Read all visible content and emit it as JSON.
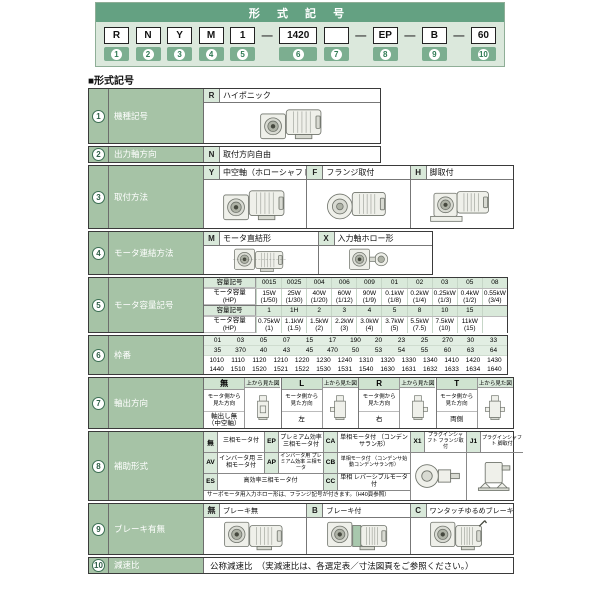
{
  "header": {
    "title": "形 式 記 号",
    "units": [
      {
        "type": "box",
        "text": "R",
        "badge": "1"
      },
      {
        "type": "box",
        "text": "N",
        "badge": "2"
      },
      {
        "type": "box",
        "text": "Y",
        "badge": "3"
      },
      {
        "type": "box",
        "text": "M",
        "badge": "4"
      },
      {
        "type": "box",
        "text": "1",
        "badge": "5"
      },
      {
        "type": "dash",
        "text": "—"
      },
      {
        "type": "box",
        "text": "1420",
        "badge": "6"
      },
      {
        "type": "box",
        "text": "",
        "badge": "7"
      },
      {
        "type": "dash",
        "text": "—"
      },
      {
        "type": "box",
        "text": "EP",
        "badge": "8"
      },
      {
        "type": "dash",
        "text": "—"
      },
      {
        "type": "box",
        "text": "B",
        "badge": "9"
      },
      {
        "type": "dash",
        "text": "—"
      },
      {
        "type": "box",
        "text": "60",
        "badge": "10"
      }
    ]
  },
  "section_heading": "■形式記号",
  "rows": {
    "r1": {
      "num": "1",
      "label": "機種記号",
      "code": "R",
      "desc": "ハイポニック"
    },
    "r2": {
      "num": "2",
      "label": "出力軸方向",
      "code": "N",
      "desc": "取付方向自由"
    },
    "r3": {
      "num": "3",
      "label": "取付方法",
      "items": [
        {
          "code": "Y",
          "desc": "中空軸（ホローシャフト）"
        },
        {
          "code": "F",
          "desc": "フランジ取付"
        },
        {
          "code": "H",
          "desc": "脚取付"
        }
      ]
    },
    "r4": {
      "num": "4",
      "label": "モータ連結方法",
      "items": [
        {
          "code": "M",
          "desc": "モータ直結形"
        },
        {
          "code": "X",
          "desc": "入力軸ホロー形"
        }
      ]
    },
    "r5": {
      "num": "5",
      "label": "モータ容量記号",
      "code_header": "容量記号",
      "cap_header": "モータ容量\n(HP)",
      "t1_codes": [
        "0015",
        "0025",
        "004",
        "006",
        "009",
        "01",
        "02",
        "03",
        "05",
        "08"
      ],
      "t1_caps": [
        "15W\n(1/50)",
        "25W\n(1/30)",
        "40W\n(1/20)",
        "60W\n(1/12)",
        "90W\n(1/9)",
        "0.1kW\n(1/8)",
        "0.2kW\n(1/4)",
        "0.25kW\n(1/3)",
        "0.4kW\n(1/2)",
        "0.55kW\n(3/4)"
      ],
      "t2_codes": [
        "1",
        "1H",
        "2",
        "3",
        "4",
        "5",
        "8",
        "10",
        "15",
        ""
      ],
      "t2_caps": [
        "0.75kW\n(1)",
        "1.1kW\n(1.5)",
        "1.5kW\n(2)",
        "2.2kW\n(3)",
        "3.0kW\n(4)",
        "3.7kW\n(5)",
        "5.5kW\n(7.5)",
        "7.5kW\n(10)",
        "11kW\n(15)",
        ""
      ]
    },
    "r6": {
      "num": "6",
      "label": "枠番",
      "line1": [
        "01",
        "03",
        "05",
        "07",
        "15",
        "17",
        "190",
        "20",
        "23",
        "25",
        "270",
        "30",
        "33"
      ],
      "line2": [
        "35",
        "370",
        "40",
        "43",
        "45",
        "470",
        "50",
        "53",
        "54",
        "55",
        "60",
        "63",
        "64"
      ],
      "line3": [
        "1010",
        "1110",
        "1120",
        "1210",
        "1220",
        "1230",
        "1240",
        "1310",
        "1320",
        "1330",
        "1340",
        "1410",
        "1420",
        "1430"
      ],
      "line4": [
        "1440",
        "1510",
        "1520",
        "1521",
        "1522",
        "1530",
        "1531",
        "1540",
        "1630",
        "1631",
        "1632",
        "1633",
        "1634",
        "1640"
      ]
    },
    "r7": {
      "num": "7",
      "label": "軸出方向",
      "top_view_label": "上から見た図",
      "view_dir_label": "モータ側から\n見た方向",
      "groups": [
        {
          "code": "無",
          "value": "軸出し無\n（中空軸）"
        },
        {
          "code": "L",
          "value": "左"
        },
        {
          "code": "R",
          "value": "右"
        },
        {
          "code": "T",
          "value": "両側"
        }
      ]
    },
    "r8": {
      "num": "8",
      "label": "補助形式",
      "row1": [
        {
          "code": "無",
          "desc": "三相モータ付"
        },
        {
          "code": "EP",
          "desc": "プレミアム効率 三相モータ付"
        },
        {
          "code": "CA",
          "desc": "単相モータ付 （コンデンサラン形）"
        },
        {
          "code": "X1",
          "desc": "プラグインシャフト フランジ取付"
        },
        {
          "code": "J1",
          "desc": "プラグインシャフト 脚取付"
        }
      ],
      "row2": [
        {
          "code": "AV",
          "desc": "インバータ用 三相モータ付"
        },
        {
          "code": "AP",
          "desc": "インバータ用 プレミアム効率 三相モータ"
        },
        {
          "code": "CB",
          "desc": "単相モータ付 （コンデンサ始動コンデンサラン形）"
        }
      ],
      "row3": [
        {
          "code": "ES",
          "desc": "高効率三相モータ付"
        },
        {
          "code": "CC",
          "desc": "単相 レバーシブルモータ付"
        }
      ],
      "note": "サーボモータ用入力ホロー形は、フランジ記号が付きます。（H40頁参照）"
    },
    "r9": {
      "num": "9",
      "label": "ブレーキ有無",
      "items": [
        {
          "code": "無",
          "desc": "ブレーキ無"
        },
        {
          "code": "B",
          "desc": "ブレーキ付"
        },
        {
          "code": "C",
          "desc": "ワンタッチゆるめブレーキ付"
        }
      ]
    },
    "r10": {
      "num": "10",
      "label": "減速比",
      "desc": "公称減速比　（実減速比は、各選定表／寸法図頁をご参照ください。）"
    }
  }
}
